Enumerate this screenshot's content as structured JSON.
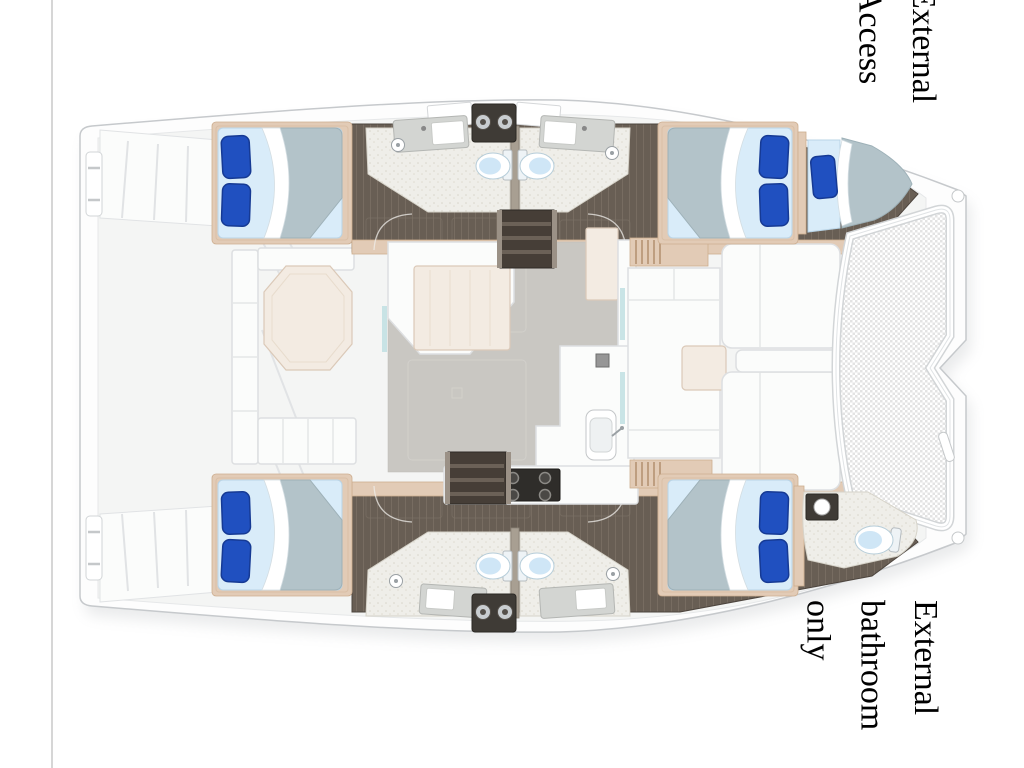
{
  "page": {
    "background": "#ffffff"
  },
  "labels": {
    "top_right": {
      "text": "External Access",
      "lines": [
        "External",
        "Access"
      ]
    },
    "bottom_right": {
      "text": "External bathroom only",
      "lines": [
        "External",
        "bathroom",
        "only"
      ]
    }
  },
  "diagram": {
    "type": "catamaran-floor-plan",
    "subject": "catamaran yacht interior deck plan, bow to the right",
    "double_beds": 4,
    "single_berths": 1,
    "toilets": 5
  },
  "palette": {
    "hull-white": "#fdfdfd",
    "hull-line": "#c6c9cc",
    "deck": "#f2f3f1",
    "deck-line": "#dfe1e3",
    "floor-dark": "#685e54",
    "trim-tan": "#e2cbb6",
    "bath-line": "#d6d3c9",
    "bed-sheet": "#d9ecf9",
    "bed-duvet": "#b3c3c9",
    "pillow-blue": "#2050c0",
    "pillow-dark": "#163a94",
    "saloon-floor": "#c9c7c2",
    "table-cream": "#f3ebe2",
    "furniture-white": "#fbfcfb",
    "furniture-line": "#dddfe1",
    "toilet-blue": "#cfe6f6",
    "steel-gray": "#d3d5d2",
    "dark-box": "#3f3b36",
    "glass-teal": "#bfdfe2",
    "rule-gray": "#c9c9c9",
    "text-black": "#000000"
  }
}
